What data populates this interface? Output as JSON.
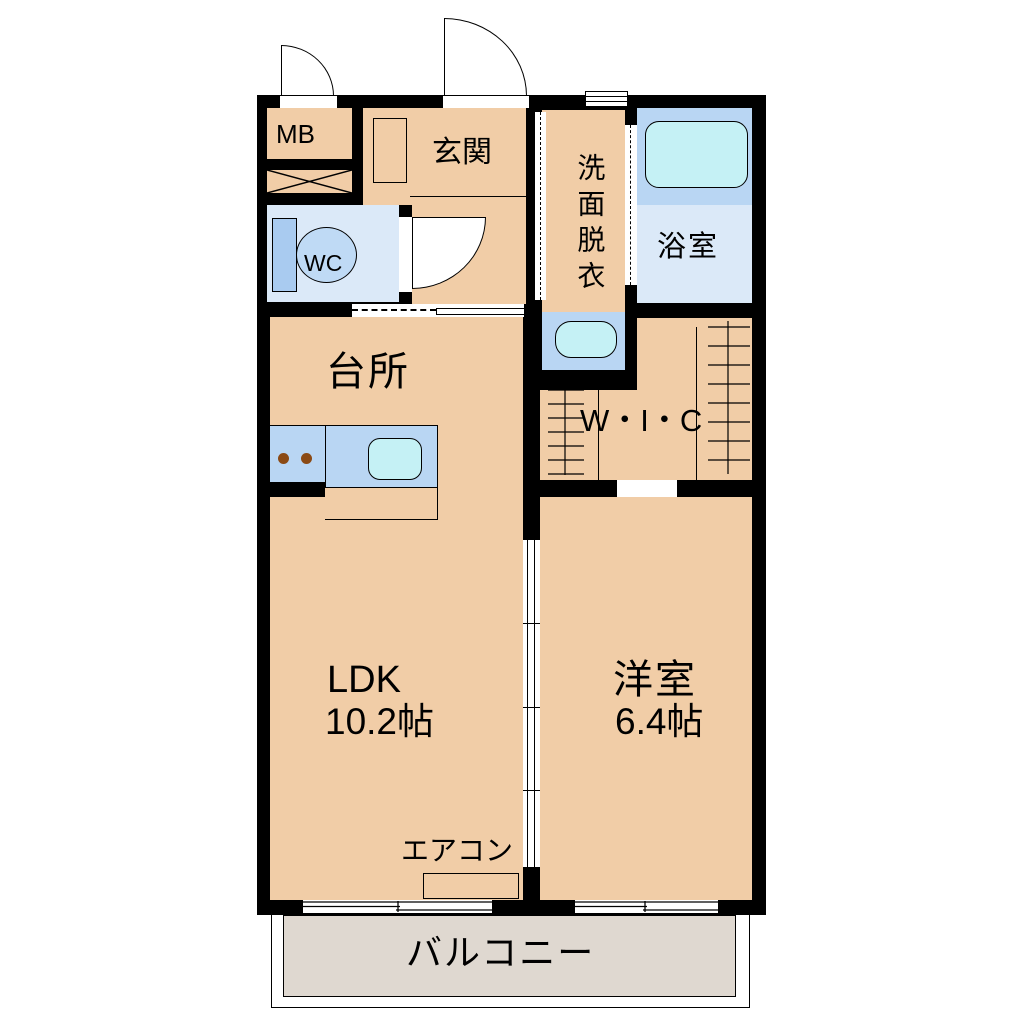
{
  "rooms": {
    "mb": {
      "label": "MB"
    },
    "entrance": {
      "label": "玄関"
    },
    "toilet": {
      "label": "WC"
    },
    "washroom": {
      "label": "洗面脱衣"
    },
    "bathroom": {
      "label": "浴室"
    },
    "closet": {
      "label": "W・I・C"
    },
    "kitchen": {
      "label": "台所"
    },
    "ldk": {
      "label": "LDK",
      "area": "10.2帖"
    },
    "bedroom": {
      "label": "洋室",
      "area": "6.4帖"
    },
    "balcony": {
      "label": "バルコニー"
    }
  },
  "fixtures": {
    "aircon": {
      "label": "エアコン"
    }
  },
  "colors": {
    "bg": "#FFFFFF",
    "wall": "#000000",
    "floor": "#F1CDA7",
    "wet-floor": "#DBE9F8",
    "fixture-blue": "#B9D6F3",
    "water-cyan": "#C5F1F5",
    "toilet-tank": "#A9CBF0",
    "toilet-bowl": "#BFDAF5",
    "balcony-floor": "#DFD8D0",
    "burner": "#8B4A14"
  }
}
